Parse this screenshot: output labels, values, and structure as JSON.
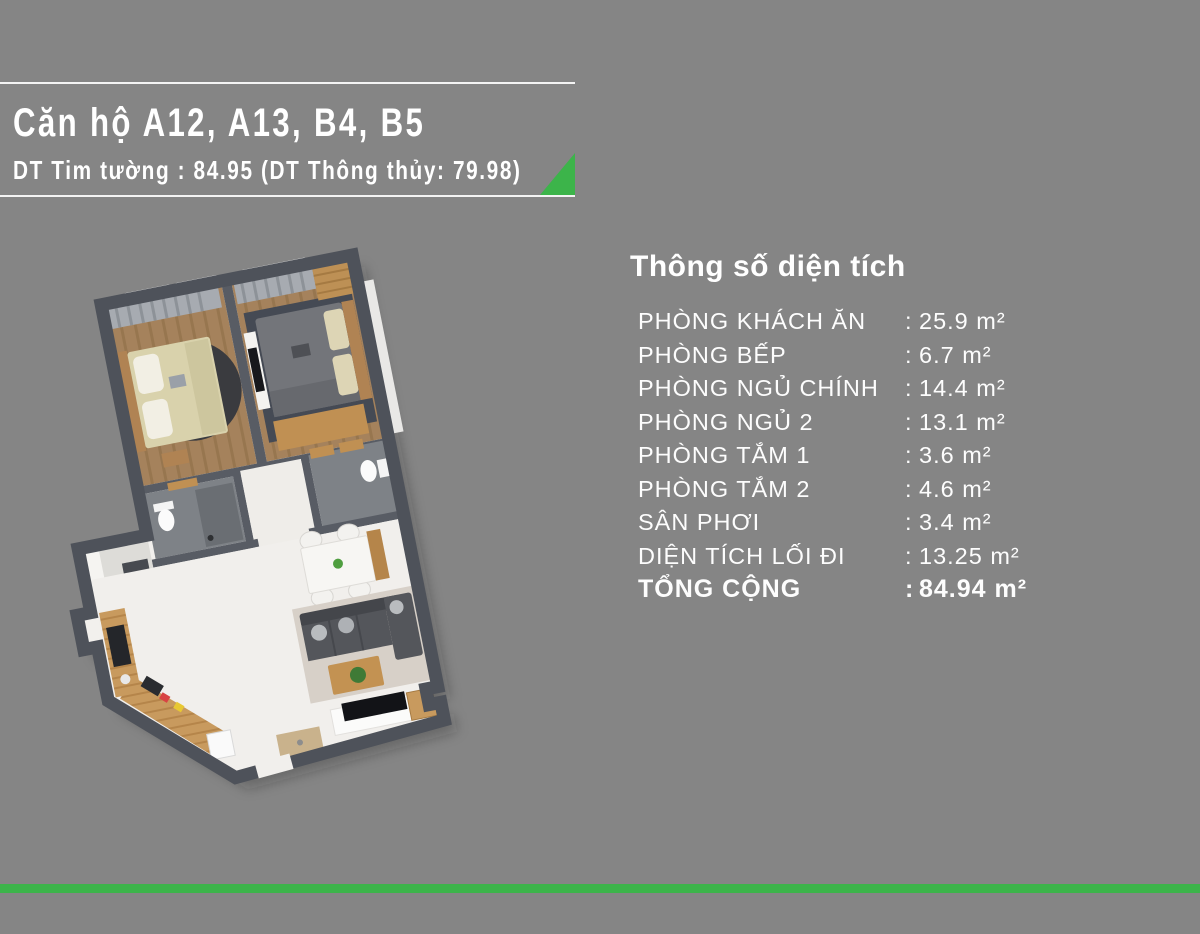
{
  "header": {
    "title": "Căn hộ A12, A13, B4, B5",
    "subtitle": "DT Tim tường : 84.95 (DT Thông thủy: 79.98)"
  },
  "panel": {
    "heading": "Thông số diện tích"
  },
  "area_table": {
    "separator": ":",
    "rows": [
      {
        "label": "PHÒNG KHÁCH ĂN",
        "value": "25.9 m²"
      },
      {
        "label": "PHÒNG BẾP",
        "value": "6.7 m²"
      },
      {
        "label": "PHÒNG NGỦ CHÍNH",
        "value": "14.4 m²"
      },
      {
        "label": "PHÒNG NGỦ 2",
        "value": "13.1 m²"
      },
      {
        "label": "PHÒNG TẮM 1",
        "value": "3.6 m²"
      },
      {
        "label": "PHÒNG TẮM 2",
        "value": "4.6 m²"
      },
      {
        "label": "SÂN PHƠI",
        "value": "3.4 m²"
      },
      {
        "label": "DIỆN TÍCH LỐI ĐI",
        "value": "13.25 m²"
      },
      {
        "label": "TỔNG CỘNG",
        "value": "84.94 m²"
      }
    ]
  },
  "colors": {
    "background": "#858585",
    "accent_green": "#3cb44a",
    "wall_dark": "#4e525a",
    "text_white": "#ffffff"
  }
}
